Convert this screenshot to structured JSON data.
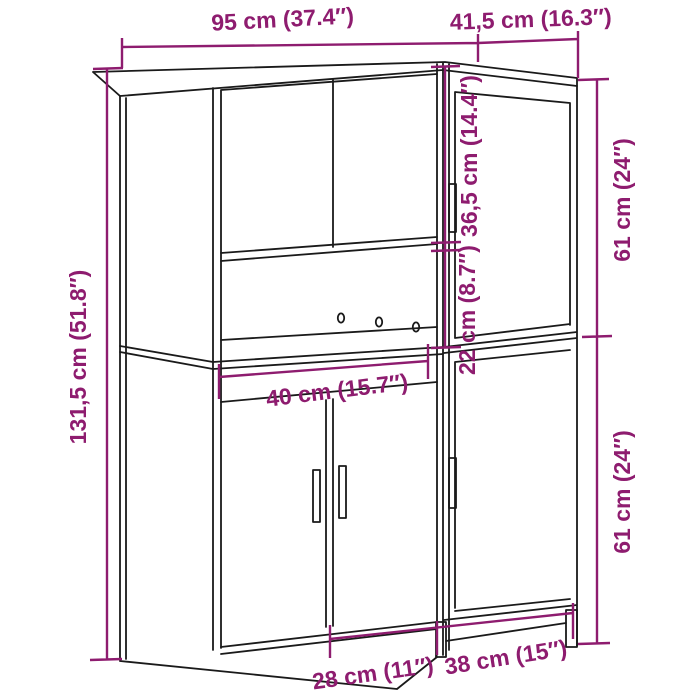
{
  "diagram": {
    "type": "cabinet-dimension-diagram",
    "accent_color": "#8e1c6f",
    "line_color": "#1a1a1a",
    "background_color": "#ffffff",
    "labels": {
      "total_width": "95 cm (37.4″)",
      "depth": "41,5 cm (16.3″)",
      "total_height": "131,5 cm (51.8″)",
      "upper_compartment_height": "36,5 cm (14.4″)",
      "lower_gap_height": "22 cm (8.7″)",
      "right_upper_height": "61 cm (24″)",
      "right_lower_height": "61 cm (24″)",
      "compartment_width": "40 cm (15.7″)",
      "left_door_width": "28 cm (11″)",
      "right_door_width": "38 cm (15″)"
    }
  }
}
